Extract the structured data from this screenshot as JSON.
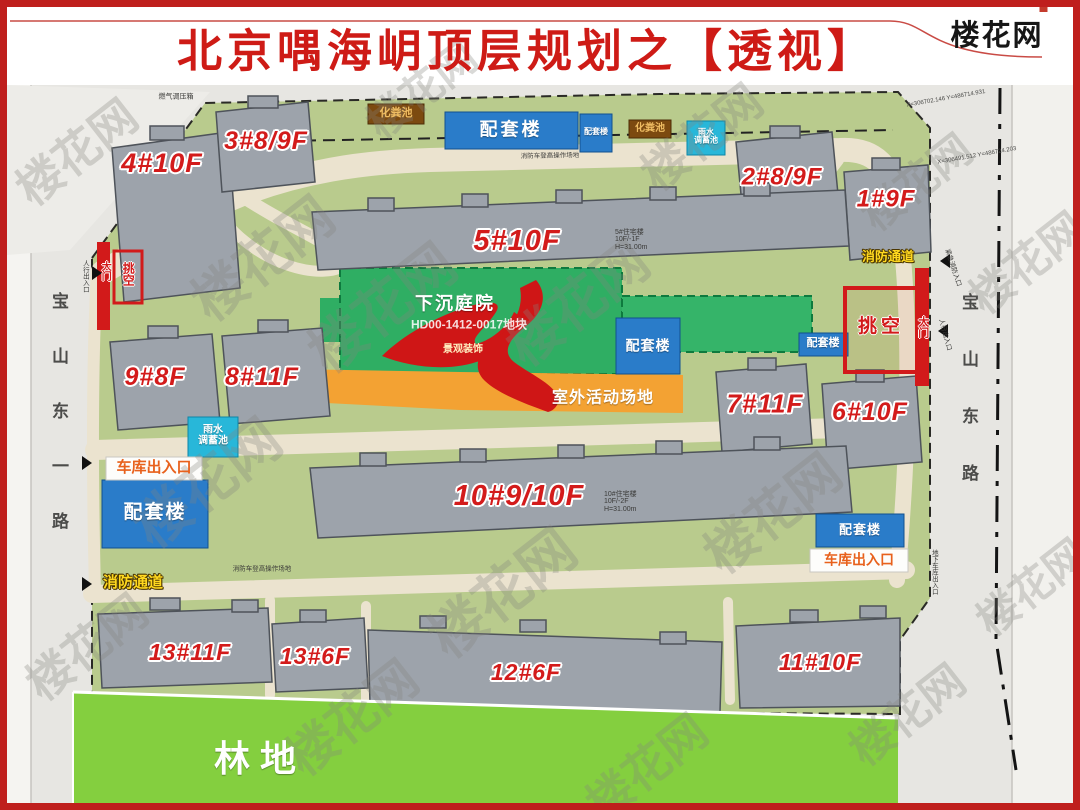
{
  "header": {
    "title": "北京喁海岄顶层规划之【透视】",
    "logo": "楼花网"
  },
  "watermark": "楼花网",
  "roads": {
    "left_name": "宝山东一路",
    "right_name": "宝山东路"
  },
  "buildings": [
    {
      "label": "4#10F"
    },
    {
      "label": "3#8/9F"
    },
    {
      "label": "2#8/9F"
    },
    {
      "label": "1#9F"
    },
    {
      "label": "5#10F"
    },
    {
      "label": "9#8F"
    },
    {
      "label": "8#11F"
    },
    {
      "label": "7#11F"
    },
    {
      "label": "6#10F"
    },
    {
      "label": "10#9/10F"
    },
    {
      "label": "13#11F"
    },
    {
      "label": "13#6F"
    },
    {
      "label": "12#6F"
    },
    {
      "label": "11#10F"
    }
  ],
  "areas": {
    "sunken_courtyard": "下沉庭院",
    "parcel_code": "HD00-1412-0017地块",
    "landscape_decor": "景观装饰",
    "outdoor_activity": "室外活动场地",
    "forest": "林地",
    "cantilever": "挑空"
  },
  "facilities": {
    "annex": "配套楼",
    "septic_tank": "化粪池",
    "rain_pool_l1": "雨水",
    "rain_pool_l2": "调蓄池",
    "garage_exit": "车库出入口",
    "fire_lane": "消防通道",
    "gate": "大门"
  },
  "annotations": {
    "bldg5_info": "5#住宅楼 10F/-1F H=31.00m",
    "bldg10_info": "10#住宅楼 10F/-2F H=31.00m",
    "gas_regulator": "燃气调压箱",
    "pedestrian_entrance": "人行出入口",
    "underground_garage_entrance": "地下车库出入口",
    "emergency_fire_entrance": "紧急消防入口",
    "fire_truck_area": "消防车登高操作场地",
    "coord_1": "X=306702.146 Y=486714.931",
    "coord_2": "X=306491.512 Y=486724.203"
  },
  "colors": {
    "frame_red": "#bf1f1d",
    "label_red": "#d31b1b",
    "site_green": "#b9cb8d",
    "courtyard_green": "#2fae63",
    "forest_green": "#84cf3f",
    "annex_blue": "#2a7cc9",
    "activity_orange": "#f3a233",
    "rain_cyan": "#28b7d9",
    "septic_brown": "#7c4a10",
    "road_gray": "#e7e6e2"
  }
}
